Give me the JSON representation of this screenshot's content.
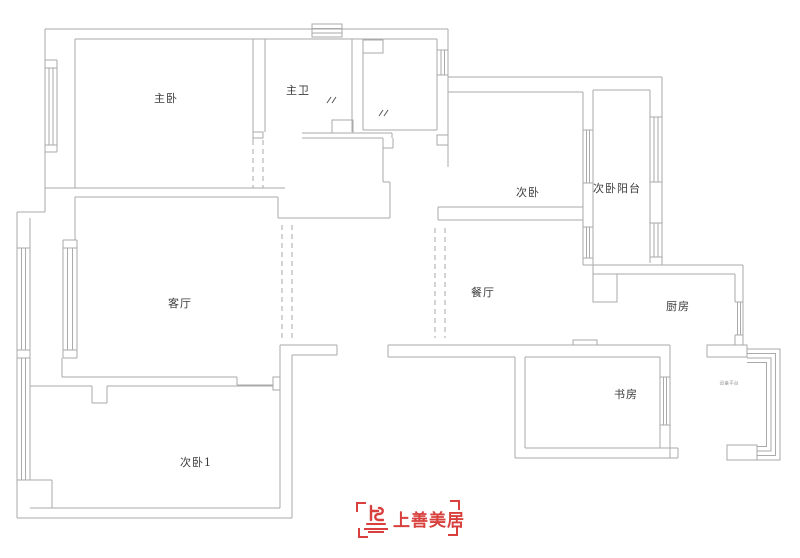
{
  "colors": {
    "wall_line": "#aaaaaa",
    "mark_line": "#555555",
    "label_text": "#3b3b3b",
    "tiny_label_text": "#9b9b9b",
    "logo_red": "#d8403d",
    "background": "#ffffff"
  },
  "rooms": [
    {
      "id": "master-bedroom",
      "label": "主卧"
    },
    {
      "id": "master-bath",
      "label": "主卫"
    },
    {
      "id": "second-bedroom",
      "label": "次卧"
    },
    {
      "id": "second-bedroom-balcony",
      "label": "次卧阳台"
    },
    {
      "id": "living-room",
      "label": "客厅"
    },
    {
      "id": "dining-room",
      "label": "餐厅"
    },
    {
      "id": "kitchen",
      "label": "厨房"
    },
    {
      "id": "study",
      "label": "书房"
    },
    {
      "id": "second-bedroom-1",
      "label": "次卧1"
    },
    {
      "id": "equipment-platform",
      "label": "设备平台"
    }
  ],
  "logo": {
    "brand": "上善美居"
  }
}
